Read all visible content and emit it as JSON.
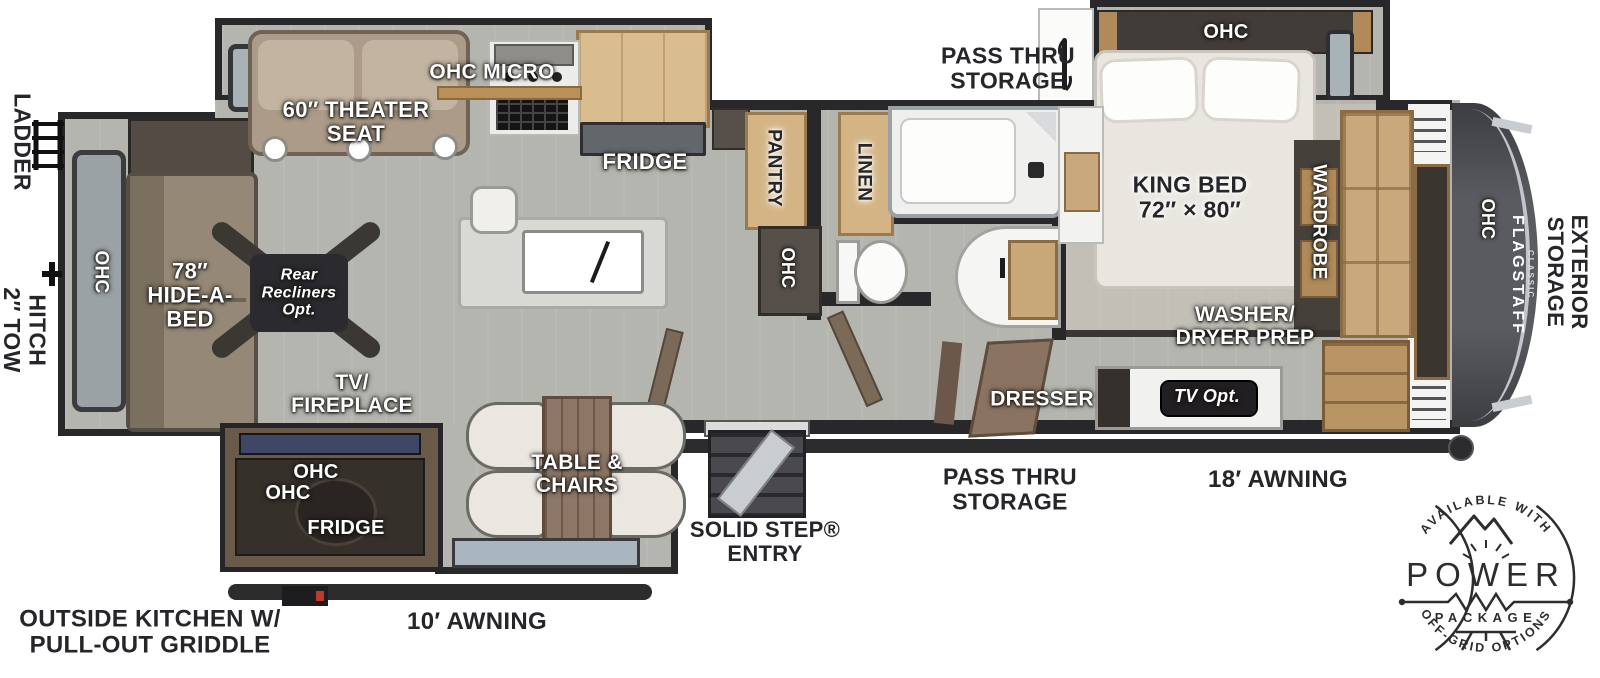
{
  "title": "Flagstaff Classic fifth wheel floor plan",
  "brand": {
    "name": "FLAGSTAFF",
    "series": "CLASSIC"
  },
  "labels": {
    "ladder": "LADDER",
    "tow_hitch": "2″ TOW\nHITCH",
    "rear_ohc": "OHC",
    "hide_a_bed": "78″\nHIDE-A-\nBED",
    "rear_recliners": "Rear\nRecliners\nOpt.",
    "theater_seat": "60″ THEATER\nSEAT",
    "ohc_micro": "OHC MICRO",
    "fridge": "FRIDGE",
    "pantry": "PANTRY",
    "pantry_ohc": "OHC",
    "linen": "LINEN",
    "pass_thru_top": "PASS THRU\nSTORAGE",
    "bed_ohc": "OHC",
    "king_bed": "KING BED\n72″ × 80″",
    "wardrobe": "WARDROBE",
    "front_ohc": "OHC",
    "exterior_storage": "EXTERIOR\nSTORAGE",
    "washer_dryer": "WASHER/\nDRYER PREP",
    "dresser": "DRESSER",
    "tv_opt": "TV Opt.",
    "tv_fireplace": "TV/\nFIREPLACE",
    "outside_ohc_1": "OHC",
    "outside_ohc_2": "OHC",
    "outside_fridge": "FRIDGE",
    "table_chairs": "TABLE &\nCHAIRS",
    "solid_step": "SOLID STEP®\nENTRY",
    "pass_thru_bottom": "PASS THRU\nSTORAGE",
    "awning_right": "18′ AWNING",
    "awning_left": "10′ AWNING",
    "outside_kitchen": "OUTSIDE KITCHEN W/\nPULL-OUT GRIDDLE"
  },
  "badge": {
    "top_arc": "AVAILABLE WITH",
    "title": "POWER",
    "subtitle": "PACKAGE",
    "bottom_arc": "OFF-GRID OPTIONS"
  },
  "colors": {
    "floor": "#b4b5ae",
    "wall": "#28282a",
    "wood_cabinet": "#d3b17c",
    "front_cap": "#4b4c50",
    "option_badge": "#2b2a2e",
    "label_white": "#ffffff",
    "label_black": "#26262a"
  }
}
